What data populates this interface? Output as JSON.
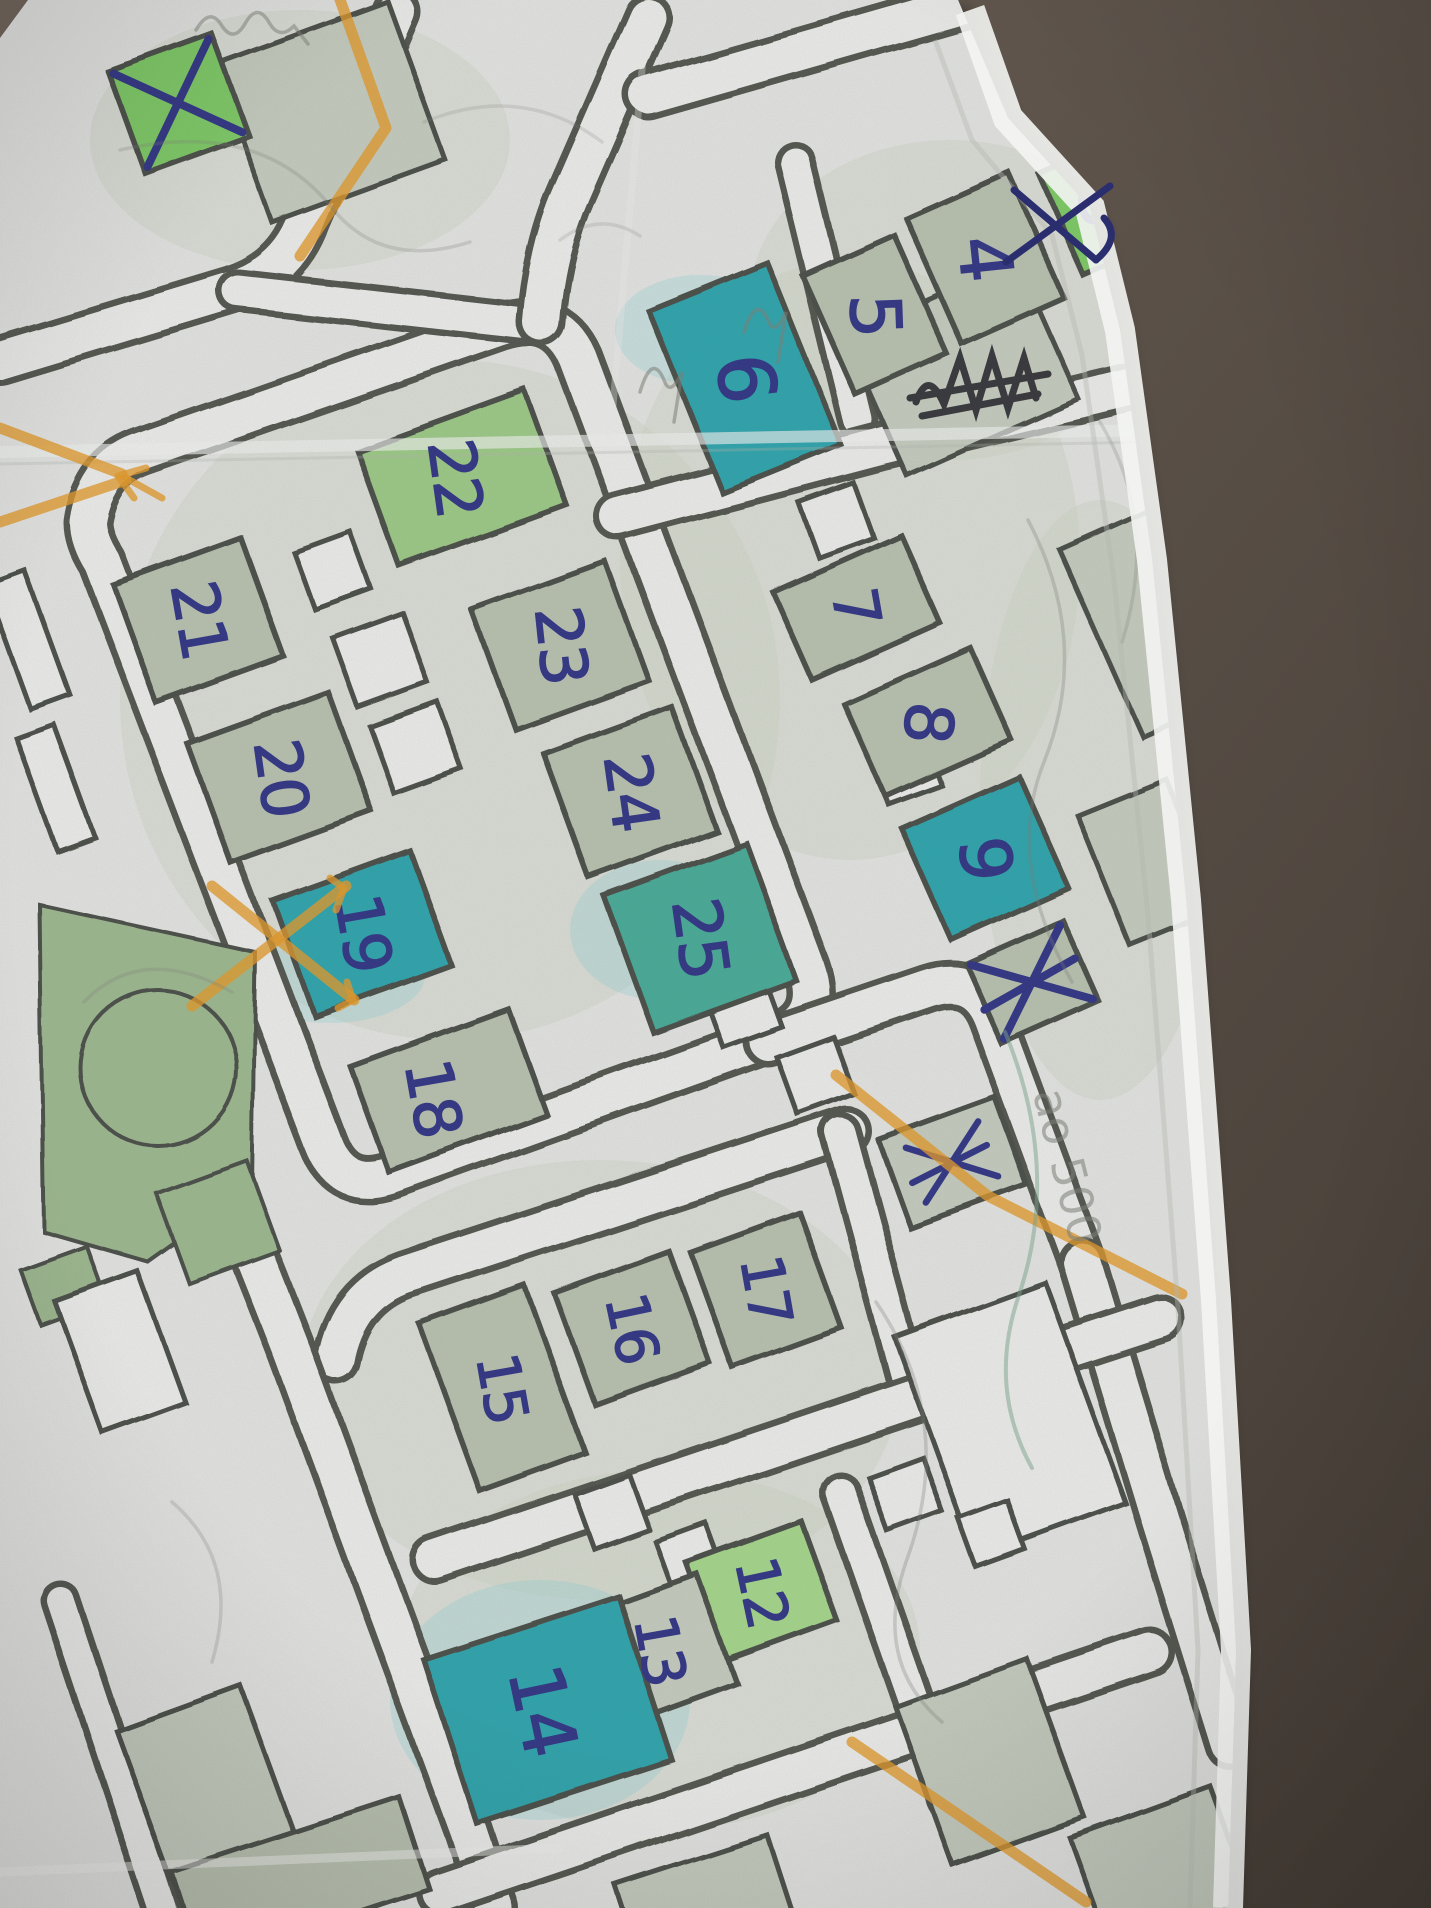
{
  "scene": {
    "description_labels": [],
    "colors": {
      "table_top": "#6e635a",
      "table_bottom": "#443c35",
      "paper": "#e6e7e5",
      "road_fill": "#efefee",
      "casing": "#4f534b",
      "building_outline": "#474b44",
      "pale": "#b9c2b0",
      "pale2": "#c6cdbf",
      "green": "#7ccb63",
      "green2": "#9ccb85",
      "lime": "#a5d88a",
      "teal": "#2ba4ad",
      "teal2": "#45ab97",
      "ink": "#2d3183",
      "ink_light": "#2a2e6e",
      "orange": "#e69a25",
      "pencil": "#7c7f76",
      "pencil_green": "#7aa58c",
      "scribble": "#23232a",
      "edge_bright": "#f4f5f3",
      "edge_shadow": "#b4b6af",
      "wash": "#ccd4c4",
      "cyan_wash": "#8fd2d8",
      "park": "#9cb98e"
    },
    "paper_polygon": "0,38 28,0 958,0 1008,118 1090,208 1120,330 1152,560 1186,900 1216,1300 1236,1650 1228,1908 0,1908",
    "edge_band": "M 970 10 L 1008 118 L 1090 208 L 1120 330 L 1152 560 L 1186 900 L 1216 1300 L 1236 1650 L 1228 1908",
    "edge_shadow_line": "M 935 40 L 972 140 L 1052 235 L 1082 355 L 1114 580 L 1148 915 L 1178 1308 L 1198 1650 L 1190 1908",
    "buildings": [
      {
        "label": "3",
        "x": 1105,
        "y": 205,
        "w": 96,
        "h": 112,
        "rot": -24,
        "fill": "green",
        "fs": 72,
        "lrot": 86
      },
      {
        "label": "4",
        "x": 985,
        "y": 258,
        "w": 112,
        "h": 138,
        "rot": -24,
        "fill": "pale",
        "fs": 72,
        "lrot": 84
      },
      {
        "label": "5",
        "x": 875,
        "y": 315,
        "w": 100,
        "h": 130,
        "rot": -24,
        "fill": "pale",
        "fs": 70,
        "lrot": 88
      },
      {
        "label": "6",
        "x": 745,
        "y": 378,
        "w": 128,
        "h": 196,
        "rot": -22,
        "fill": "teal",
        "fs": 78,
        "lrot": 84
      },
      {
        "label": "7",
        "x": 856,
        "y": 607,
        "w": 140,
        "h": 96,
        "rot": -24,
        "fill": "pale",
        "fs": 62,
        "lrot": 80
      },
      {
        "label": "8",
        "x": 928,
        "y": 722,
        "w": 138,
        "h": 100,
        "rot": -24,
        "fill": "pale",
        "fs": 66,
        "lrot": 95
      },
      {
        "label": "9",
        "x": 985,
        "y": 858,
        "w": 128,
        "h": 122,
        "rot": -24,
        "fill": "teal",
        "fs": 70,
        "lrot": 84
      },
      {
        "label": "",
        "x": 1032,
        "y": 982,
        "w": 106,
        "h": 88,
        "rot": -24,
        "fill": "pale",
        "crossed": true,
        "extra": true
      },
      {
        "label": "",
        "x": 952,
        "y": 1162,
        "w": 124,
        "h": 94,
        "rot": -20,
        "fill": "pale2",
        "crossed": true,
        "small": true,
        "extra": true
      },
      {
        "label": "",
        "x": 178,
        "y": 103,
        "w": 110,
        "h": 108,
        "rot": -20,
        "fill": "green",
        "crossed": true
      },
      {
        "label": "22",
        "x": 462,
        "y": 478,
        "w": 178,
        "h": 122,
        "rot": -20,
        "fill": "green2",
        "fs": 64,
        "lrot": 82,
        "lx": -8
      },
      {
        "label": "23",
        "x": 560,
        "y": 645,
        "w": 142,
        "h": 126,
        "rot": -20,
        "fill": "pale",
        "fs": 64,
        "lrot": 84
      },
      {
        "label": "24",
        "x": 630,
        "y": 792,
        "w": 136,
        "h": 132,
        "rot": -20,
        "fill": "pale",
        "fs": 64,
        "lrot": 82
      },
      {
        "label": "25",
        "x": 700,
        "y": 938,
        "w": 152,
        "h": 146,
        "rot": -20,
        "fill": "teal2",
        "fs": 66,
        "lrot": 82
      },
      {
        "label": "21",
        "x": 198,
        "y": 620,
        "w": 136,
        "h": 126,
        "rot": -20,
        "fill": "pale",
        "fs": 64,
        "lrot": 80
      },
      {
        "label": "20",
        "x": 280,
        "y": 778,
        "w": 150,
        "h": 126,
        "rot": -20,
        "fill": "pale",
        "fs": 64,
        "lrot": 82
      },
      {
        "label": "19",
        "x": 362,
        "y": 933,
        "w": 146,
        "h": 122,
        "rot": -20,
        "fill": "teal",
        "fs": 64,
        "lrot": 80
      },
      {
        "label": "18",
        "x": 448,
        "y": 1090,
        "w": 168,
        "h": 112,
        "rot": -20,
        "fill": "pale",
        "fs": 64,
        "lrot": 80,
        "lx": -16,
        "ly": 8
      },
      {
        "label": "15",
        "x": 502,
        "y": 1388,
        "w": 112,
        "h": 178,
        "rot": -20,
        "fill": "pale",
        "fs": 58,
        "lrot": 80
      },
      {
        "label": "16",
        "x": 632,
        "y": 1328,
        "w": 122,
        "h": 118,
        "rot": -20,
        "fill": "pale",
        "fs": 58,
        "lrot": 78
      },
      {
        "label": "17",
        "x": 766,
        "y": 1290,
        "w": 116,
        "h": 122,
        "rot": -20,
        "fill": "pale",
        "fs": 58,
        "lrot": 80
      },
      {
        "label": "12",
        "x": 762,
        "y": 1592,
        "w": 122,
        "h": 106,
        "rot": -20,
        "fill": "lime",
        "fs": 58,
        "lrot": 78
      },
      {
        "label": "13",
        "x": 660,
        "y": 1650,
        "w": 122,
        "h": 116,
        "rot": -20,
        "fill": "pale2",
        "fs": 58,
        "lrot": 80
      },
      {
        "label": "14",
        "x": 548,
        "y": 1710,
        "w": 205,
        "h": 172,
        "rot": -18,
        "fill": "teal",
        "fs": 74,
        "lrot": 78,
        "lx": -6
      }
    ],
    "outline_buildings": [
      {
        "x": 962,
        "y": 368,
        "w": 188,
        "h": 152,
        "rot": -24,
        "fill": "pale2"
      },
      {
        "x": 1130,
        "y": 118,
        "w": 150,
        "h": 180,
        "rot": -24,
        "fill": "pale2"
      },
      {
        "x": 1152,
        "y": 620,
        "w": 112,
        "h": 205,
        "rot": -24,
        "fill": "pale2"
      },
      {
        "x": 1148,
        "y": 862,
        "w": 96,
        "h": 140,
        "rot": -22,
        "fill": "pale2"
      },
      {
        "x": 1010,
        "y": 1420,
        "w": 160,
        "h": 235,
        "rot": -20,
        "fill": "road_fill"
      },
      {
        "x": 990,
        "y": 1762,
        "w": 140,
        "h": 168,
        "rot": -20,
        "fill": "pale2"
      },
      {
        "x": 120,
        "y": 1352,
        "w": 88,
        "h": 140,
        "rot": -20,
        "fill": "road_fill"
      },
      {
        "x": 205,
        "y": 1782,
        "w": 132,
        "h": 158,
        "rot": -20,
        "fill": "pale2"
      },
      {
        "x": 330,
        "y": 112,
        "w": 184,
        "h": 168,
        "rot": -20,
        "fill": "pale2"
      },
      {
        "x": 300,
        "y": 1880,
        "w": 240,
        "h": 96,
        "rot": -18,
        "fill": "pale"
      },
      {
        "x": 705,
        "y": 1902,
        "w": 160,
        "h": 88,
        "rot": -18,
        "fill": "pale2"
      },
      {
        "x": 1160,
        "y": 1868,
        "w": 150,
        "h": 120,
        "rot": -20,
        "fill": "pale2"
      },
      {
        "x": 28,
        "y": 640,
        "w": 42,
        "h": 132,
        "rot": -20,
        "fill": "road_fill"
      },
      {
        "x": 56,
        "y": 788,
        "w": 40,
        "h": 120,
        "rot": -20,
        "fill": "road_fill"
      }
    ],
    "small_squares": [
      {
        "x": 380,
        "y": 660,
        "s": 74
      },
      {
        "x": 416,
        "y": 748,
        "s": 72
      },
      {
        "x": 332,
        "y": 570,
        "s": 60
      },
      {
        "x": 905,
        "y": 768,
        "s": 56
      },
      {
        "x": 836,
        "y": 520,
        "s": 58
      },
      {
        "x": 742,
        "y": 1008,
        "s": 62
      },
      {
        "x": 815,
        "y": 1075,
        "s": 60
      },
      {
        "x": 612,
        "y": 1512,
        "s": 58
      },
      {
        "x": 690,
        "y": 1558,
        "s": 54
      },
      {
        "x": 905,
        "y": 1494,
        "s": 58
      },
      {
        "x": 992,
        "y": 1534,
        "s": 52
      }
    ],
    "parks": {
      "polygon": "40,905 255,952 252,1188 148,1262 44,1232",
      "circle": {
        "cx": 158,
        "cy": 1068,
        "r": 78
      },
      "rects": [
        {
          "x": 218,
          "y": 1222,
          "w": 96,
          "h": 96,
          "rot": -20
        },
        {
          "x": 64,
          "y": 1286,
          "w": 70,
          "h": 58,
          "rot": -20
        }
      ]
    },
    "roads": [
      {
        "d": "M 88 522 Q 96 468 142 452 L 498 328 Q 556 308 578 358 L 806 968 Q 824 1018 776 1036 L 392 1174 Q 342 1192 324 1144 L 102 562 Q 88 540 88 522 Z"
      },
      {
        "d": "M 0 360 L 232 290 Q 288 272 306 220 L 396 12"
      },
      {
        "d": "M 238 291 L 524 323",
        "w": 44
      },
      {
        "d": "M 541 322 Q 547 248 572 192 L 648 18"
      },
      {
        "d": "M 648 95 L 1120 -40"
      },
      {
        "d": "M 795 162 L 858 420",
        "w": 42
      },
      {
        "d": "M 618 516 L 884 446 L 1160 380"
      },
      {
        "d": "M 768 1042 L 928 988 Q 975 973 992 1018 L 1082 1262"
      },
      {
        "d": "M 1082 1262 L 1160 1520 L 1230 1745"
      },
      {
        "d": "M 336 1360 Q 348 1295 404 1275 L 846 1130"
      },
      {
        "d": "M 840 1132 L 912 1398",
        "w": 42
      },
      {
        "d": "M 435 1560 L 940 1390 L 1160 1318"
      },
      {
        "d": "M 243 1228 Q 268 1290 292 1352 L 468 1830 L 494 1908"
      },
      {
        "d": "M 440 1892 L 1150 1652"
      },
      {
        "d": "M 840 1492 L 948 1800",
        "w": 42
      },
      {
        "d": "M 60 1600 L 162 1908",
        "w": 40
      }
    ],
    "orange_lines": [
      {
        "d": "M 0 428 L 122 474"
      },
      {
        "d": "M 0 522 L 126 480"
      },
      {
        "d": "M 146 468 L 118 476 L 134 498",
        "w": 7
      },
      {
        "d": "M 126 478 L 162 498",
        "w": 7
      },
      {
        "d": "M 338 -6 L 386 128 L 300 256"
      },
      {
        "d": "M 192 1006 L 346 886"
      },
      {
        "d": "M 330 878 L 344 888 L 336 910",
        "w": 7
      },
      {
        "d": "M 212 886 L 354 1000"
      },
      {
        "d": "M 338 1008 L 353 1000 L 347 982",
        "w": 7
      },
      {
        "d": "M 836 1075 L 988 1196 L 1182 1294"
      },
      {
        "d": "M 852 1742 L 1086 1902"
      },
      {
        "d": "M 1242 30 L 1424 58",
        "op": 0.5
      }
    ],
    "ink_extra_marks": [
      {
        "d": "M 1006 262 L 1110 186"
      },
      {
        "d": "M 1014 190 L 1096 260"
      },
      {
        "d": "M 1096 260 Q 1122 238 1104 218"
      }
    ],
    "black_scribble": [
      "M 916 402 Q 928 368 944 404 L 960 358 L 976 410 L 992 356 L 1008 408 L 1024 358 L 1036 398",
      "M 910 398 L 1048 374",
      "M 922 416 L 1038 394"
    ],
    "pencil_marks": [
      {
        "d": "M 196 30 Q 210 6 222 26 Q 234 44 246 22 Q 258 2 270 24 Q 280 40 294 26 L 308 44",
        "op": 0.5
      },
      {
        "d": "M 640 392 Q 652 352 664 380 Q 670 398 682 372 L 674 422",
        "op": 0.55
      },
      {
        "d": "M 744 332 Q 756 294 768 320 Q 774 338 786 312 L 778 362",
        "op": 0.55
      },
      {
        "d": "M 120 150 Q 260 118 332 208 Q 382 270 470 242",
        "op": 0.25
      },
      {
        "d": "M 1028 520 Q 1092 642 1044 762 Q 1004 862 1072 982",
        "op": 0.3
      },
      {
        "d": "M 84 1002 Q 142 942 232 992",
        "op": 0.25
      },
      {
        "d": "M 172 1502 Q 242 1562 212 1662",
        "op": 0.25
      },
      {
        "d": "M 424 122 Q 522 82 602 142",
        "op": 0.2
      },
      {
        "d": "M 1100 422 Q 1160 522 1122 642",
        "op": 0.25
      },
      {
        "d": "M 876 1302 Q 958 1422 906 1562 Q 872 1662 942 1722",
        "op": 0.3
      },
      {
        "d": "M 560 240 Q 600 210 640 236",
        "op": 0.2
      }
    ],
    "pencil_green_mark": "M 1005 1032 Q 1062 1170 1018 1298 Q 988 1388 1032 1468",
    "pencil_texts": [
      {
        "t": "ao 500",
        "x": 1052,
        "y": 1170,
        "rot": 76,
        "size": 46,
        "op": 0.55
      }
    ],
    "washes": [
      {
        "x": 450,
        "y": 700,
        "rx": 330,
        "ry": 340
      },
      {
        "x": 850,
        "y": 560,
        "rx": 230,
        "ry": 300
      },
      {
        "x": 600,
        "y": 1380,
        "rx": 300,
        "ry": 220
      },
      {
        "x": 660,
        "y": 1650,
        "rx": 260,
        "ry": 180
      },
      {
        "x": 950,
        "y": 300,
        "rx": 200,
        "ry": 160
      },
      {
        "x": 300,
        "y": 140,
        "rx": 210,
        "ry": 130
      },
      {
        "x": 1100,
        "y": 800,
        "rx": 120,
        "ry": 300
      }
    ],
    "cyan_washes": [
      {
        "x": 700,
        "y": 330,
        "rx": 85,
        "ry": 55
      },
      {
        "x": 330,
        "y": 975,
        "rx": 95,
        "ry": 48
      },
      {
        "x": 540,
        "y": 1700,
        "rx": 150,
        "ry": 120
      },
      {
        "x": 660,
        "y": 930,
        "rx": 90,
        "ry": 70
      }
    ],
    "creases": [
      {
        "d": "M 0 452 L 1150 430",
        "w": 12,
        "c": "#f3f4f2",
        "op": 0.65
      },
      {
        "d": "M 0 464 L 1150 442",
        "w": 3,
        "c": "#b4b6af",
        "op": 0.3
      },
      {
        "d": "M 0 1872 L 560 1848",
        "w": 9,
        "c": "#f3f4f2",
        "op": 0.5
      },
      {
        "d": "M 648 0 L 610 440",
        "w": 7,
        "c": "#f0f1ef",
        "op": 0.35
      }
    ]
  }
}
